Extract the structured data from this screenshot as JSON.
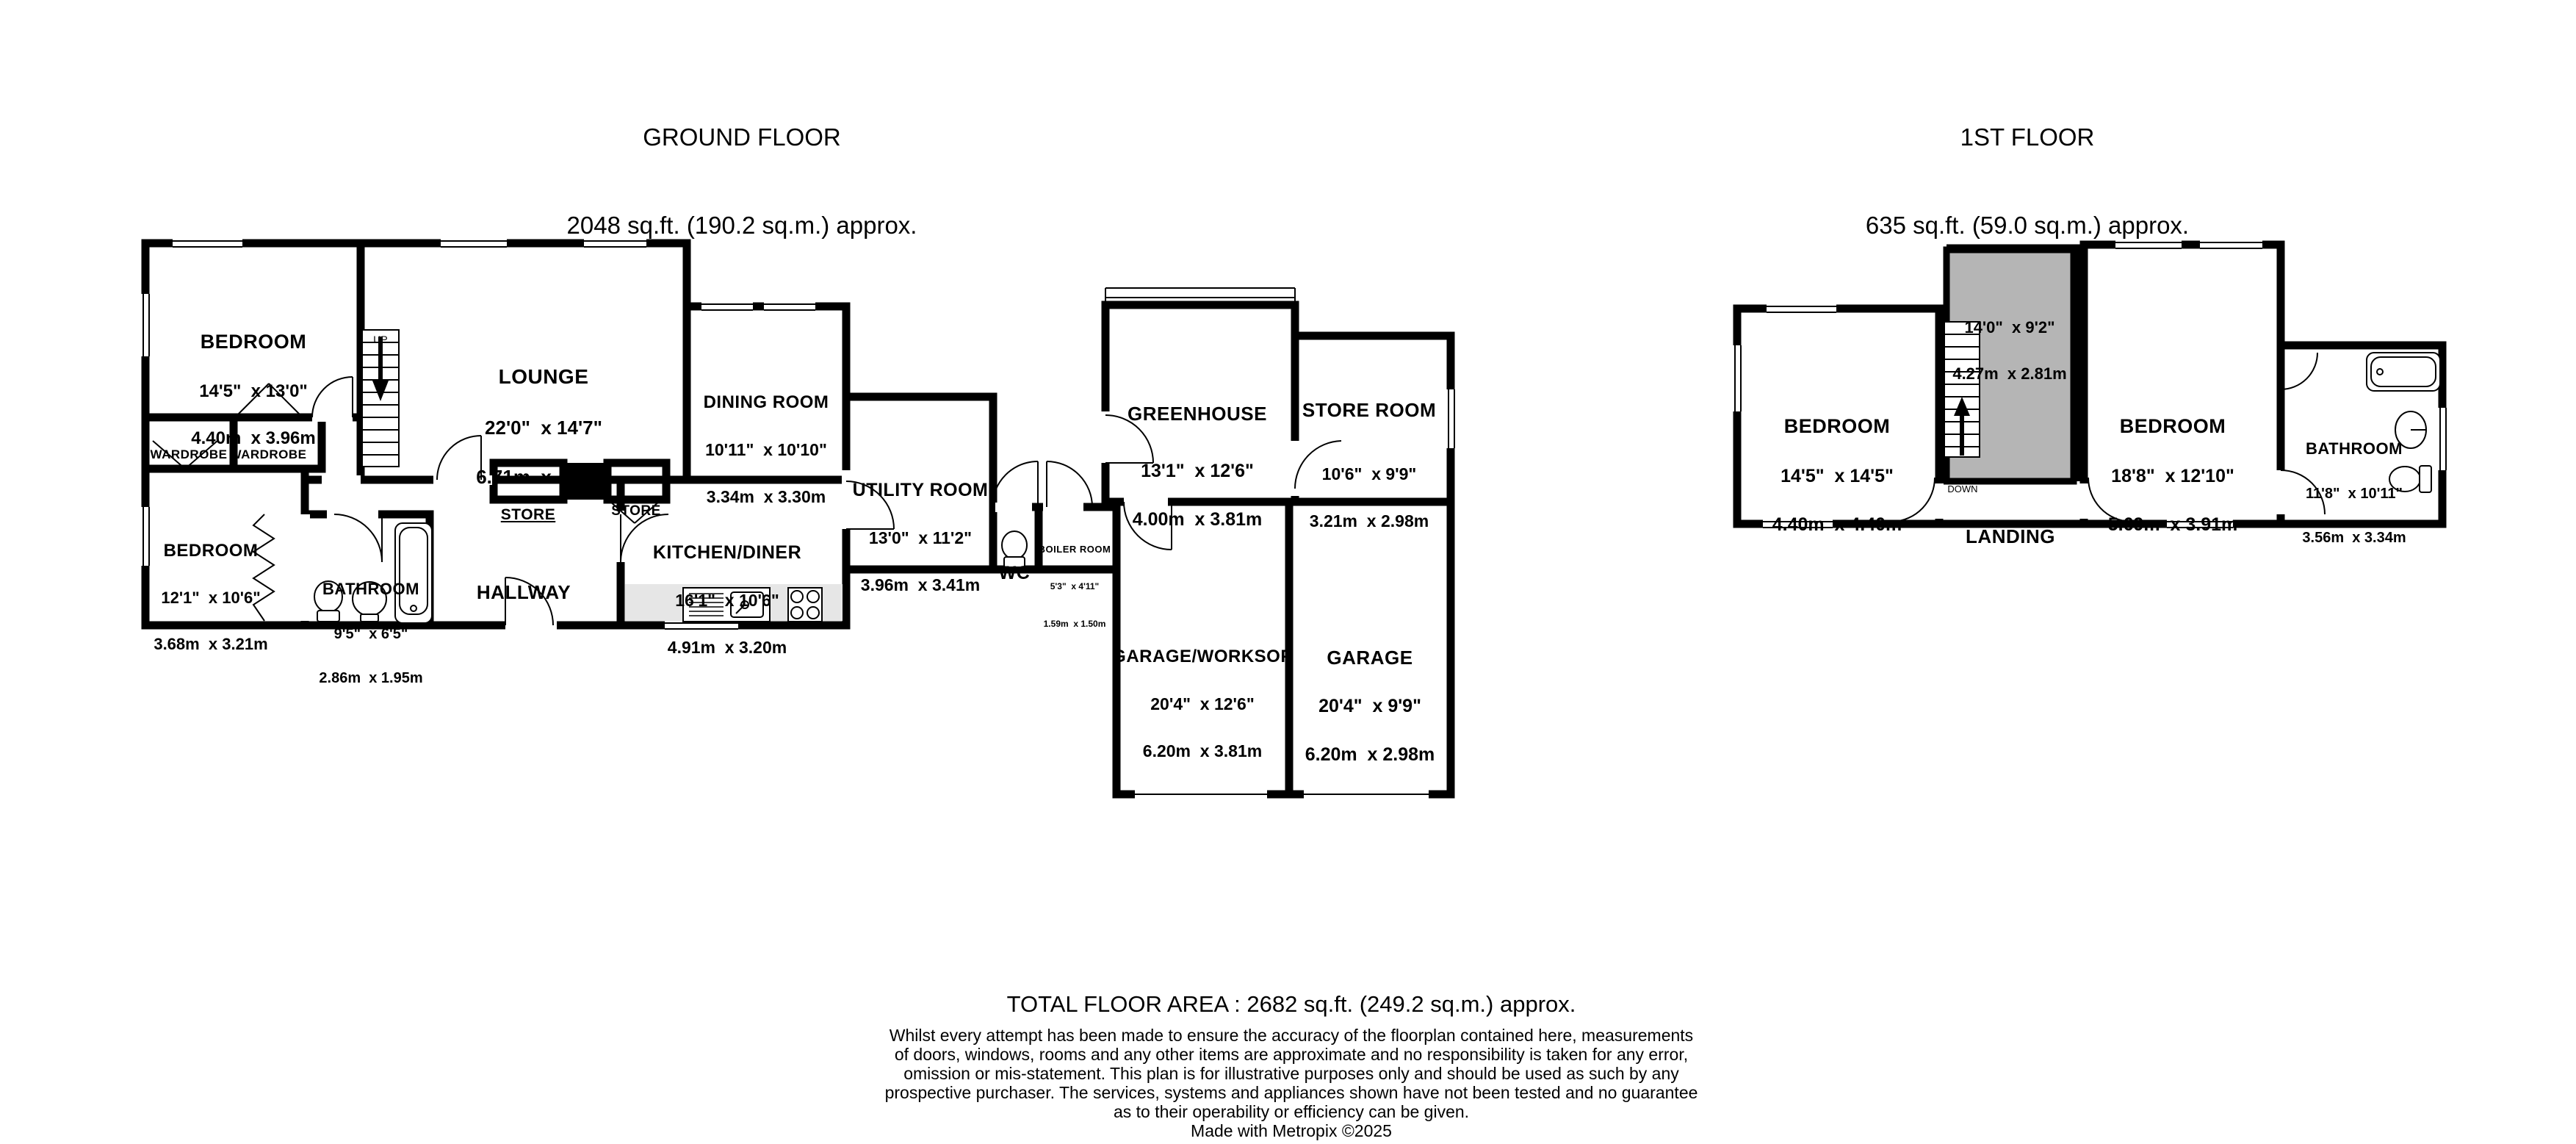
{
  "ground_floor": {
    "title": "GROUND FLOOR",
    "area": "2048 sq.ft. (190.2 sq.m.) approx.",
    "stairs_label": "UP",
    "rooms": {
      "bedroom_front": {
        "name": "BEDROOM",
        "imperial": "14'5\"  x 13'0\"",
        "metric": "4.40m  x 3.96m"
      },
      "wardrobe_left": {
        "name": "WARDROBE"
      },
      "wardrobe_right": {
        "name": "WARDROBE"
      },
      "lounge": {
        "name": "LOUNGE",
        "imperial": "22'0\"  x 14'7\"",
        "metric": "6.71m  x 4.44m"
      },
      "dining_room": {
        "name": "DINING ROOM",
        "imperial": "10'11\"  x 10'10\"",
        "metric": "3.34m  x 3.30m"
      },
      "bedroom_rear": {
        "name": "BEDROOM",
        "imperial": "12'1\"  x 10'6\"",
        "metric": "3.68m  x 3.21m"
      },
      "bathroom": {
        "name": "BATHROOM",
        "imperial": "9'5\"  x 6'5\"",
        "metric": "2.86m  x 1.95m"
      },
      "hallway": {
        "name": "HALLWAY"
      },
      "store_left": {
        "name": "STORE"
      },
      "store_right": {
        "name": "STORE"
      },
      "kitchen_diner": {
        "name": "KITCHEN/DINER",
        "imperial": "16'1\"  x 10'6\"",
        "metric": "4.91m  x 3.20m"
      },
      "utility_room": {
        "name": "UTILITY ROOM",
        "imperial": "13'0\"  x 11'2\"",
        "metric": "3.96m  x 3.41m"
      },
      "wc": {
        "name": "WC"
      },
      "boiler_room": {
        "name": "BOILER ROOM",
        "imperial": "5'3\"  x 4'11\"",
        "metric": "1.59m  x 1.50m"
      },
      "greenhouse": {
        "name": "GREENHOUSE",
        "imperial": "13'1\"  x 12'6\"",
        "metric": "4.00m  x 3.81m"
      },
      "store_room": {
        "name": "STORE ROOM",
        "imperial": "10'6\"  x 9'9\"",
        "metric": "3.21m  x 2.98m"
      },
      "garage_workshop": {
        "name": "GARAGE/WORKSOP",
        "imperial": "20'4\"  x 12'6\"",
        "metric": "6.20m  x 3.81m"
      },
      "garage": {
        "name": "GARAGE",
        "imperial": "20'4\"  x 9'9\"",
        "metric": "6.20m  x 2.98m"
      }
    }
  },
  "first_floor": {
    "title": "1ST FLOOR",
    "area": "635 sq.ft. (59.0 sq.m.) approx.",
    "stairs_label": "DOWN",
    "rooms": {
      "bedroom_left": {
        "name": "BEDROOM",
        "imperial": "14'5\"  x 14'5\"",
        "metric": "4.40m  x 4.40m"
      },
      "restricted_area": {
        "imperial": "14'0\"  x 9'2\"",
        "metric": "4.27m  x 2.81m"
      },
      "bedroom_right": {
        "name": "BEDROOM",
        "imperial": "18'8\"  x 12'10\"",
        "metric": "5.69m  x 3.91m"
      },
      "bathroom": {
        "name": "BATHROOM",
        "imperial": "11'8\"  x 10'11\"",
        "metric": "3.56m  x 3.34m"
      },
      "landing": {
        "name": "LANDING"
      }
    }
  },
  "footer": {
    "total_area": "TOTAL FLOOR AREA : 2682 sq.ft. (249.2 sq.m.) approx.",
    "disclaimer_lines": [
      "Whilst every attempt has been made to ensure the accuracy of the floorplan contained here, measurements",
      "of doors, windows, rooms and any other items are approximate and no responsibility is taken for any error,",
      "omission or mis-statement. This plan is for illustrative purposes only and should be used as such by any",
      "prospective purchaser. The services, systems and appliances shown have not been tested and no guarantee",
      "as to their operability or efficiency can be given."
    ],
    "credit": "Made with Metropix ©2025"
  },
  "colors": {
    "wall": "#000000",
    "restricted_area": "#b5b5b5",
    "kitchen_counter": "#e6e6e6",
    "background": "#ffffff"
  }
}
